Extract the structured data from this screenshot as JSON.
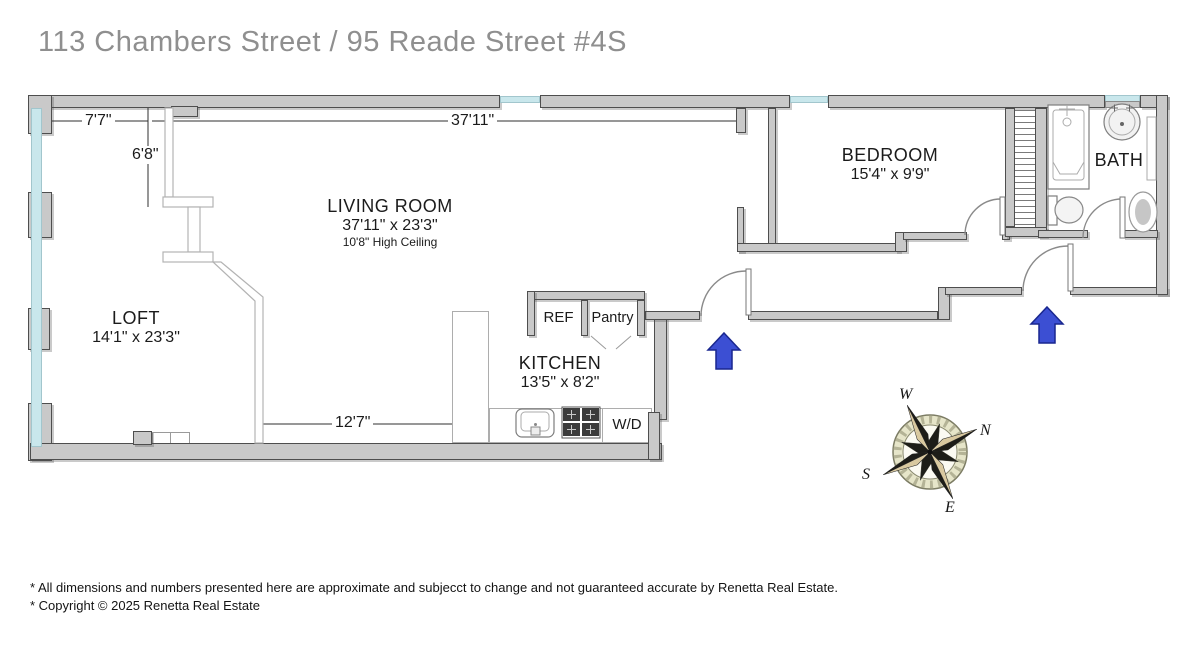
{
  "title": "113 Chambers Street / 95 Reade Street #4S",
  "rooms": {
    "living": {
      "name": "LIVING ROOM",
      "dims": "37'11\" x 23'3\"",
      "note": "10'8\" High Ceiling"
    },
    "loft": {
      "name": "LOFT",
      "dims": "14'1\" x 23'3\""
    },
    "kitchen": {
      "name": "KITCHEN",
      "dims": "13'5\" x 8'2\""
    },
    "bedroom": {
      "name": "BEDROOM",
      "dims": "15'4\" x 9'9\""
    },
    "bath": {
      "name": "BATH"
    }
  },
  "fixtures": {
    "ref": "REF",
    "pantry": "Pantry",
    "washer_dryer": "W/D"
  },
  "measurements": {
    "top_left": "7'7\"",
    "left_vertical": "6'8\"",
    "top_main": "37'11\"",
    "bottom_left": "12'7\""
  },
  "compass": {
    "north": "N",
    "south": "S",
    "east": "E",
    "west": "W"
  },
  "footer": {
    "disclaimer": "* All dimensions and numbers presented here are approximate and subjecct to change and not guaranteed accurate by Renetta Real Estate.",
    "copyright": "* Copyright © 2025 Renetta Real Estate"
  },
  "colors": {
    "wall": "#c9c9c9",
    "wall_border": "#4e4e4e",
    "window": "#c9e7ec",
    "window_border": "#a2c6cd",
    "arrow": "#3c4fd3",
    "arrow_border": "#19278f",
    "compass_ring": "#e6e5c9",
    "compass_star": "#1d1d18",
    "compass_accent": "#d9c9a0",
    "title_color": "#8f8f8f",
    "text": "#1b1b1b",
    "dim_line": "#2f2f2f",
    "rail_line": "#b3b3b3",
    "fixture_line": "#7d7d7d"
  }
}
